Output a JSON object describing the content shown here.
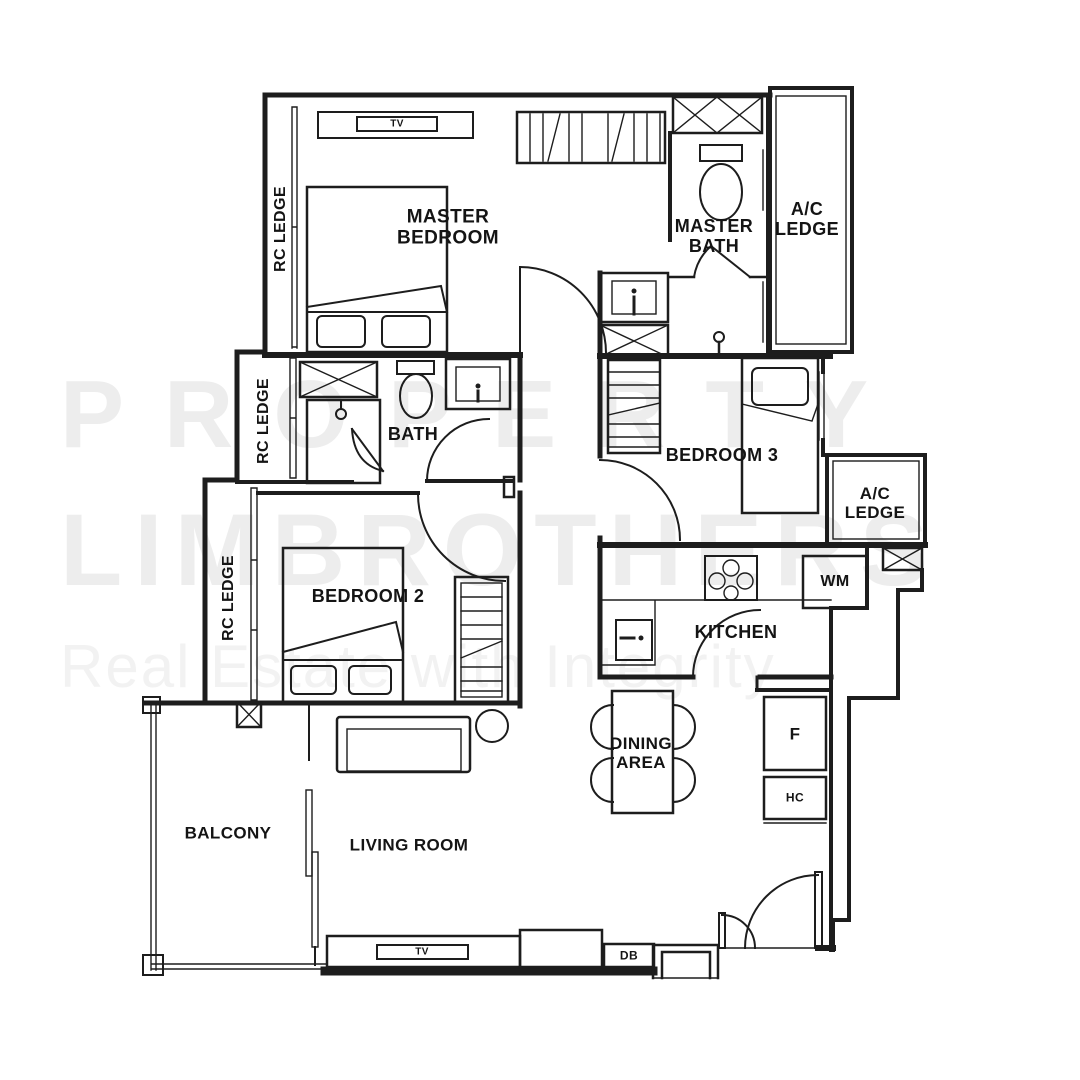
{
  "floor_plan": {
    "watermark": {
      "line1": "PROPERTY",
      "line2": "LIMBROTHERS",
      "tagline": "Real Estate with Integrity"
    },
    "labels": {
      "rc_ledge_top": "RC LEDGE",
      "rc_ledge_mid": "RC LEDGE",
      "rc_ledge_lower": "RC LEDGE",
      "master_bedroom_l1": "MASTER",
      "master_bedroom_l2": "BEDROOM",
      "master_bath_l1": "MASTER",
      "master_bath_l2": "BATH",
      "ac_ledge_top_l1": "A/C",
      "ac_ledge_top_l2": "LEDGE",
      "ac_ledge_mid_l1": "A/C",
      "ac_ledge_mid_l2": "LEDGE",
      "bath": "BATH",
      "bedroom_3": "BEDROOM 3",
      "bedroom_2": "BEDROOM 2",
      "kitchen": "KITCHEN",
      "washing_machine": "WM",
      "dining_l1": "DINING",
      "dining_l2": "AREA",
      "fridge": "F",
      "hc": "HC",
      "balcony": "BALCONY",
      "living_room": "LIVING ROOM",
      "tv_master": "TV",
      "tv_living": "TV",
      "db": "DB"
    },
    "colors": {
      "wall": "#1d1d1d",
      "watermark": "#ededed",
      "watermark_tagline": "#f2f2f2",
      "background": "#ffffff"
    }
  }
}
